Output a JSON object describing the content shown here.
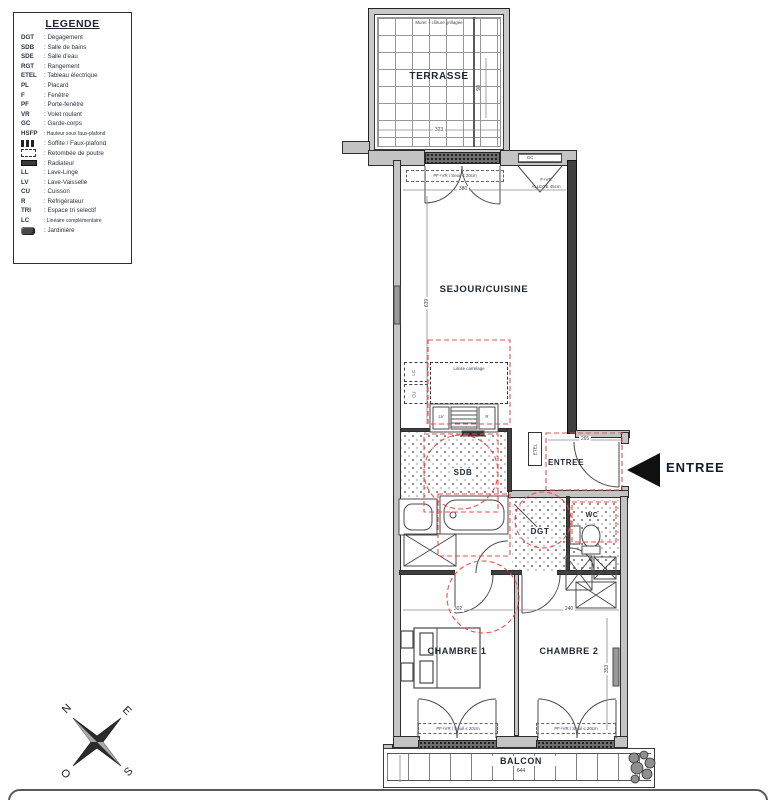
{
  "legend": {
    "title": "LEGENDE",
    "items": [
      {
        "abbr": "DGT",
        "label": "Dégagement"
      },
      {
        "abbr": "SDB",
        "label": "Salle de bains"
      },
      {
        "abbr": "SDE",
        "label": "Salle d'eau"
      },
      {
        "abbr": "RGT",
        "label": "Rangement"
      },
      {
        "abbr": "ETEL",
        "label": "Tableau électrique"
      },
      {
        "abbr": "PL",
        "label": "Placard"
      },
      {
        "abbr": "F",
        "label": "Fenêtre"
      },
      {
        "abbr": "PF",
        "label": "Porte-fenêtre"
      },
      {
        "abbr": "VR",
        "label": "Volet roulant"
      },
      {
        "abbr": "GC",
        "label": "Garde-corps"
      },
      {
        "abbr": "HSFP",
        "label": "Hauteur sous faux-plafond"
      },
      {
        "icon": "soffite-icon",
        "label": "Soffite / Faux-plafond"
      },
      {
        "icon": "beam-icon",
        "label": "Retombée de poutre"
      },
      {
        "icon": "radiator-icon",
        "label": "Radiateur"
      },
      {
        "abbr": "LL",
        "label": "Lave-Linge"
      },
      {
        "abbr": "LV",
        "label": "Lave-Vaisselle"
      },
      {
        "abbr": "CU",
        "label": "Cuisson"
      },
      {
        "abbr": "R",
        "label": "Réfrigérateur"
      },
      {
        "abbr": "TRI",
        "label": "Espace tri selectif"
      },
      {
        "abbr": "LC",
        "label": "Linéaire complémentaire"
      },
      {
        "icon": "planter-icon",
        "label": "Jardinière"
      }
    ]
  },
  "plan": {
    "terrace": {
      "label": "TERRASSE",
      "note": "Muret + clôture grillagée",
      "dim_width": "323",
      "dim_side": "90"
    },
    "living": {
      "label": "SEJOUR/CUISINE",
      "dim_width": "380",
      "dim_height": "639",
      "door_note": "PF+VR / Seuil ≤ 20cm",
      "guard_label": "GC",
      "window_label": "F+VR",
      "window_sill": "ALLEGE 45cm",
      "tile_limit": "Limite carrelage"
    },
    "kitchen": {
      "lc": "LC",
      "cu": "CU",
      "lv": "LV",
      "fridge": "R"
    },
    "bathroom": {
      "label": "SDB"
    },
    "electrical": {
      "label": "ETEL"
    },
    "hall": {
      "label": "ENTREE",
      "dim_width": "265"
    },
    "entry": {
      "label": "ENTREE"
    },
    "wc": {
      "label": "WC"
    },
    "corridor": {
      "label": "DGT"
    },
    "bedroom1": {
      "label": "CHAMBRE 1",
      "dim_width": "302"
    },
    "bedroom2": {
      "label": "CHAMBRE 2",
      "dim_width": "240",
      "dim_height": "353"
    },
    "balcony": {
      "label": "BALCON",
      "dim_width": "644",
      "door_note": "PF+VR / Seuil ≤ 20cm"
    },
    "compass": {
      "n": "N",
      "e": "E",
      "s": "S",
      "o": "O"
    }
  },
  "colors": {
    "accent_red": "#ef4d4e",
    "wall_fill": "#c4c4c4",
    "wall_dark": "#3f3f3f",
    "line": "#2e2e2e",
    "text": "#1e2633"
  }
}
